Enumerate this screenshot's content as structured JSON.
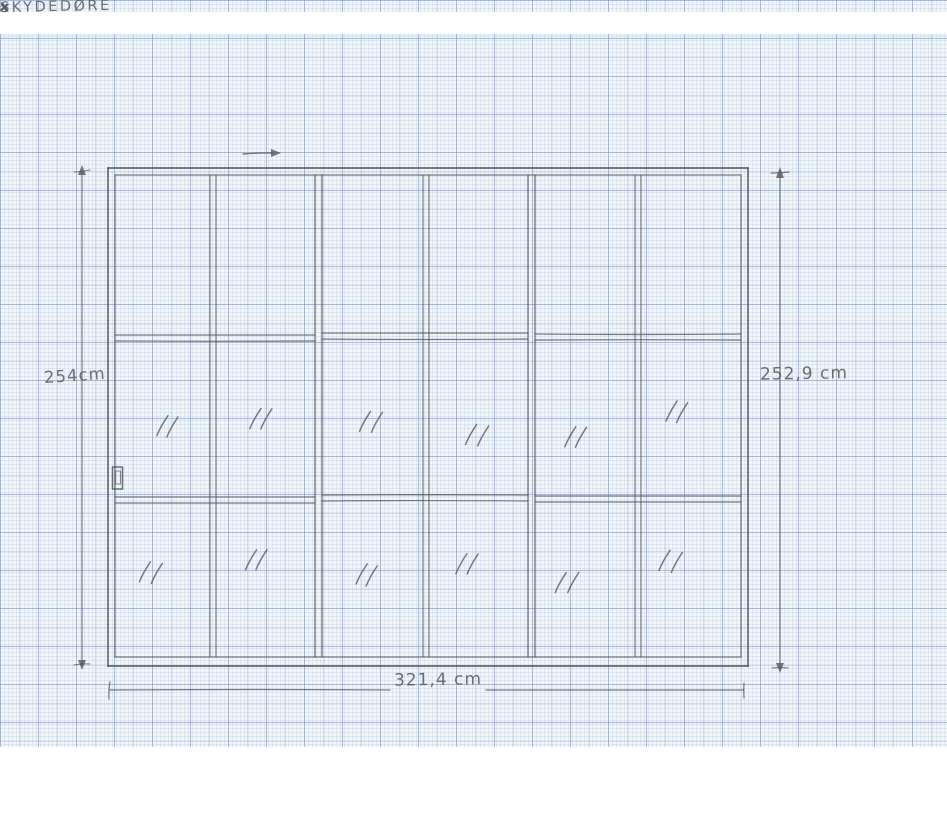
{
  "colors": {
    "pencil": "#54585c",
    "paper": "#f1f6fa",
    "grid_fine": "rgba(125,160,205,0.16)",
    "grid_mid": "rgba(110,150,200,0.26)",
    "grid_major": "rgba(95,140,195,0.38)"
  },
  "annotations": {
    "top_label": "SKYDEDØRE",
    "top_mark_left": "x",
    "top_mark_right": "x",
    "dim_left": "254cm",
    "dim_right": "252,9 cm",
    "dim_bottom": "321,4 cm"
  },
  "label_positions": {
    "top_label": [
      157,
      141
    ],
    "top_mark_left": [
      108,
      143
    ],
    "top_mark_right": [
      310,
      150
    ],
    "dim_left": [
      44,
      368
    ],
    "dim_right": [
      760,
      366
    ],
    "dim_bottom": [
      394,
      672
    ]
  },
  "drawing": {
    "panels_count": 3,
    "columns_per_panel": 2,
    "rows": 3,
    "glass_mark_rows": [
      "middle",
      "bottom"
    ],
    "frame_outer": [
      108,
      168,
      748,
      666
    ],
    "frame_inner": [
      115,
      175,
      741,
      657
    ],
    "panel_boundaries": [
      [
        315,
        322
      ],
      [
        528,
        535
      ]
    ],
    "mullions": [
      [
        210,
        216
      ],
      [
        423,
        429
      ],
      [
        635,
        641
      ]
    ],
    "rails": [
      [
        115,
        315,
        335,
        341
      ],
      [
        322,
        528,
        333,
        339
      ],
      [
        535,
        741,
        334,
        340
      ],
      [
        115,
        315,
        497,
        503
      ],
      [
        322,
        528,
        495,
        501
      ],
      [
        535,
        741,
        496,
        502
      ]
    ],
    "glass_marks": [
      [
        168,
        424
      ],
      [
        262,
        416
      ],
      [
        372,
        420
      ],
      [
        478,
        432
      ],
      [
        576,
        434
      ],
      [
        678,
        410
      ],
      [
        152,
        570
      ],
      [
        258,
        557
      ],
      [
        368,
        572
      ],
      [
        468,
        561
      ],
      [
        568,
        580
      ],
      [
        672,
        559
      ]
    ],
    "handle": {
      "outer": [
        112.5,
        467,
        10,
        22
      ],
      "inner": [
        115.5,
        471,
        5,
        13
      ]
    },
    "dim_left_line": {
      "x": 82,
      "y1": 171,
      "y2": 665
    },
    "dim_right_line": {
      "x": 780,
      "y1": 175,
      "y2": 668
    },
    "dim_bottom_line": {
      "y": 690,
      "x1": 110,
      "x2": 744,
      "gap": [
        390,
        486
      ]
    },
    "top_arrow": {
      "x1": 243,
      "x2": 272,
      "y": 154,
      "tip": 281
    }
  }
}
